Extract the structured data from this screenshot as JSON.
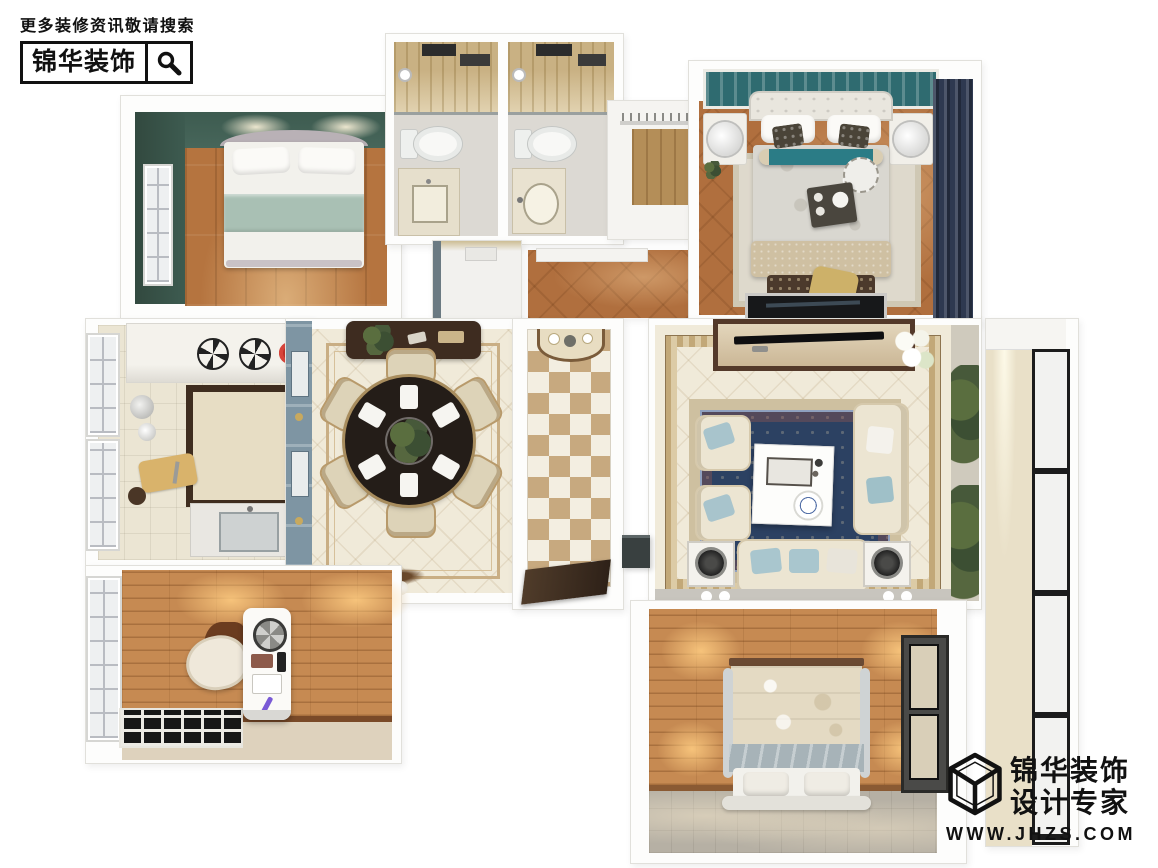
{
  "brand": {
    "tagline": "更多装修资讯敬请搜索",
    "name": "锦华装饰",
    "search_icon": "magnifier-icon"
  },
  "footer": {
    "line1": "锦华装饰",
    "line2": "设计专家",
    "website": "WWW.JHZS.COM",
    "logo_icon": "cube-logo-icon"
  },
  "palette": {
    "ink": "#111111",
    "teal-wall": "#3d5b50",
    "wood": "#b5743f",
    "parquet": "#b06f3e",
    "navy-curtain": "#2e3950",
    "rug-navy": "#2c4162",
    "cream-floor": "#f0ead9",
    "tile-tan": "#c7a97f",
    "wood-wall": "#c68a52",
    "headboard-teal": "#2f6b70",
    "sage": "#a9c0b4",
    "gold-tile": "#c9b183"
  }
}
